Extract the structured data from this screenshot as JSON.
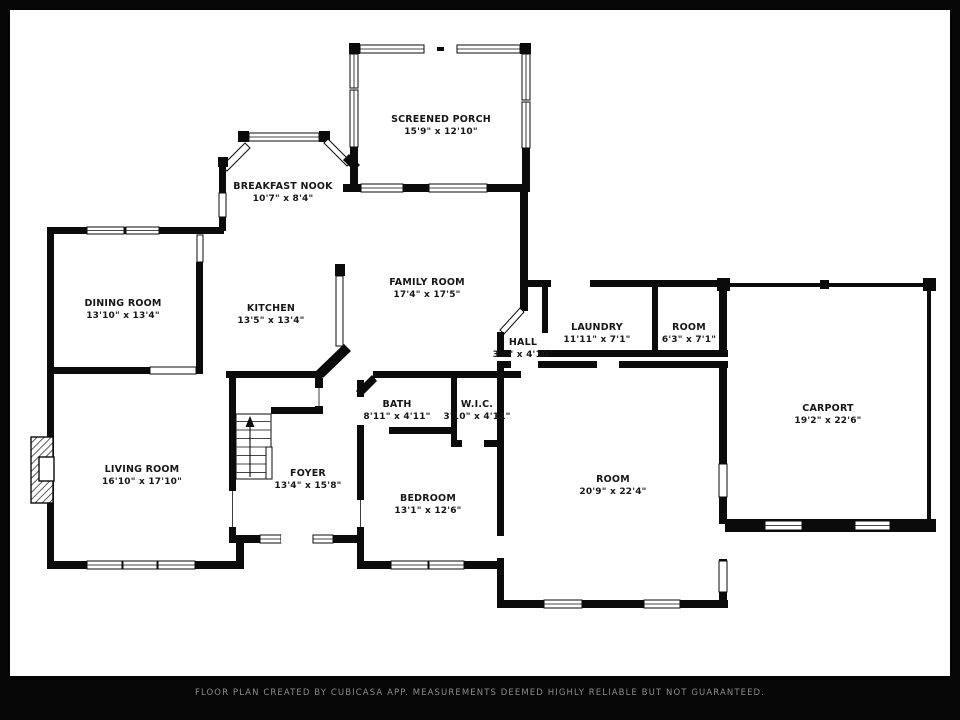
{
  "footer": {
    "text": "FLOOR PLAN CREATED BY CUBICASA APP. MEASUREMENTS DEEMED HIGHLY RELIABLE BUT NOT GUARANTEED."
  },
  "rooms": {
    "screened_porch": {
      "name": "SCREENED PORCH",
      "dims": "15'9\" x 12'10\""
    },
    "breakfast_nook": {
      "name": "BREAKFAST NOOK",
      "dims": "10'7\" x 8'4\""
    },
    "dining_room": {
      "name": "DINING ROOM",
      "dims": "13'10\" x 13'4\""
    },
    "kitchen": {
      "name": "KITCHEN",
      "dims": "13'5\" x 13'4\""
    },
    "family_room": {
      "name": "FAMILY ROOM",
      "dims": "17'4\" x 17'5\""
    },
    "laundry": {
      "name": "LAUNDRY",
      "dims": "11'11\" x 7'1\""
    },
    "room_small": {
      "name": "ROOM",
      "dims": "6'3\" x 7'1\""
    },
    "hall": {
      "name": "HALL",
      "dims": "3'8\" x 4'10\""
    },
    "carport": {
      "name": "CARPORT",
      "dims": "19'2\" x 22'6\""
    },
    "bath": {
      "name": "BATH",
      "dims": "8'11\" x 4'11\""
    },
    "wic": {
      "name": "W.I.C.",
      "dims": "3'10\" x 4'11\""
    },
    "living_room": {
      "name": "LIVING ROOM",
      "dims": "16'10\" x 17'10\""
    },
    "foyer": {
      "name": "FOYER",
      "dims": "13'4\" x 15'8\""
    },
    "bedroom": {
      "name": "BEDROOM",
      "dims": "13'1\" x 12'6\""
    },
    "room_large": {
      "name": "ROOM",
      "dims": "20'9\" x 22'4\""
    }
  },
  "colors": {
    "wall": "#0b0b0b",
    "background": "#ffffff",
    "frame": "#050505",
    "footer_text": "#8d8d8d"
  }
}
